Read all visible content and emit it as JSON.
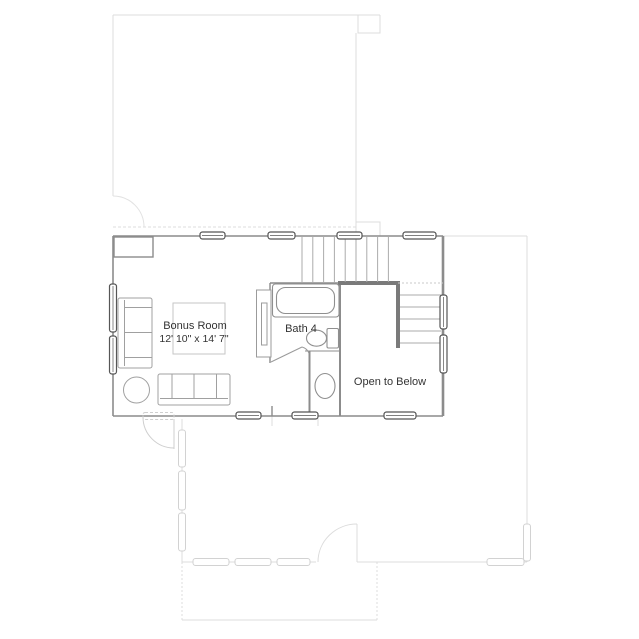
{
  "floor_plan": {
    "bonus_room": {
      "label": "Bonus Room",
      "dimensions": "12' 10\" x 14' 7\""
    },
    "bath": {
      "label": "Bath 4"
    },
    "stairwell": {
      "label": "Open to Below"
    }
  },
  "colors": {
    "wall": "#8c8c8c",
    "thick_wall": "#7a7a7a",
    "window_border": "#565656",
    "fixture": "#8f8f8f",
    "furniture": "#a0a0a0",
    "rug": "#c6c6c6",
    "tread": "#ababab",
    "faint_outline": "#dcdcdc",
    "faint_arc": "#e2e2e2",
    "text": "#333333"
  }
}
